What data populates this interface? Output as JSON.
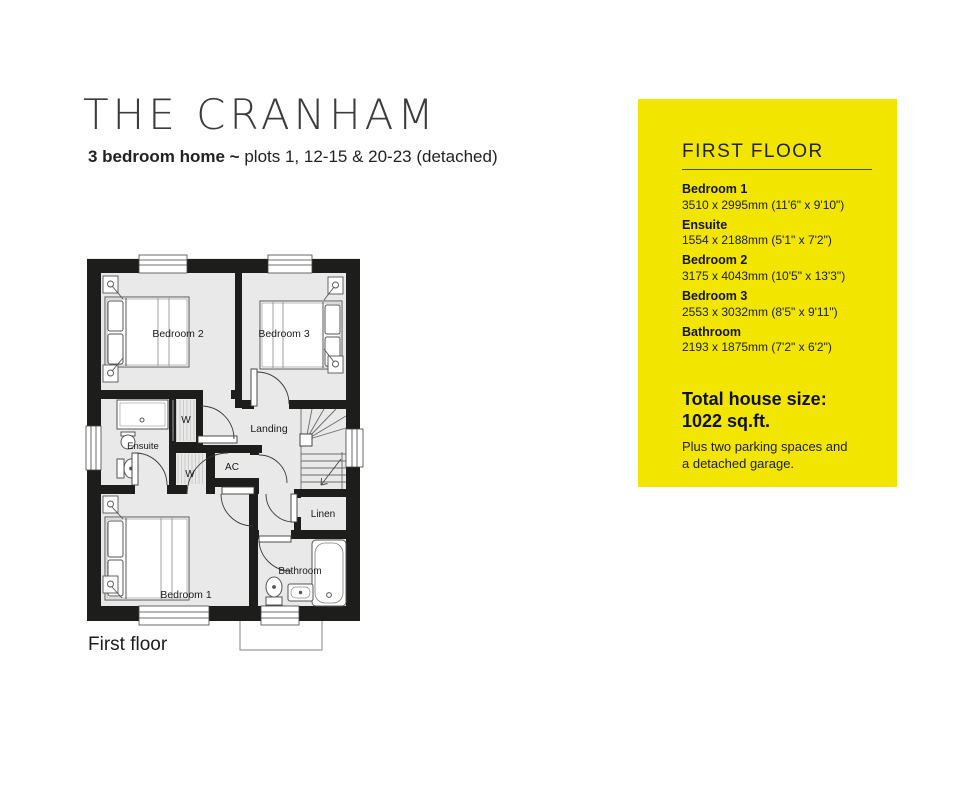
{
  "header": {
    "title": "THE CRANHAM",
    "subtitle_bold": "3 bedroom home ~",
    "subtitle_rest": " plots 1, 12-15 & 20-23 (detached)"
  },
  "floorplan": {
    "caption": "First floor",
    "wall_color": "#1d1d1b",
    "floor_color": "#e9e9e9",
    "labels": {
      "bedroom1": "Bedroom 1",
      "bedroom2": "Bedroom 2",
      "bedroom3": "Bedroom 3",
      "ensuite": "Ensuite",
      "landing": "Landing",
      "bathroom": "Bathroom",
      "linen": "Linen",
      "airing_cupboard": "AC",
      "wardrobe_top": "W",
      "wardrobe_bottom": "W"
    }
  },
  "panel": {
    "heading": "FIRST FLOOR",
    "accent_color": "#F2E500",
    "rooms": [
      {
        "name": "Bedroom 1",
        "dims": "3510 x 2995mm (11'6\" x 9'10\")"
      },
      {
        "name": "Ensuite",
        "dims": "1554 x 2188mm (5'1\" x 7'2\")"
      },
      {
        "name": "Bedroom 2",
        "dims": "3175 x 4043mm (10'5\" x 13'3\")"
      },
      {
        "name": "Bedroom 3",
        "dims": "2553 x 3032mm (8'5\" x 9'11\")"
      },
      {
        "name": "Bathroom",
        "dims": "2193 x 1875mm (7'2\" x 6'2\")"
      }
    ],
    "total_label": "Total house size:",
    "total_value": "1022 sq.ft.",
    "note": "Plus two parking spaces and a detached garage."
  }
}
